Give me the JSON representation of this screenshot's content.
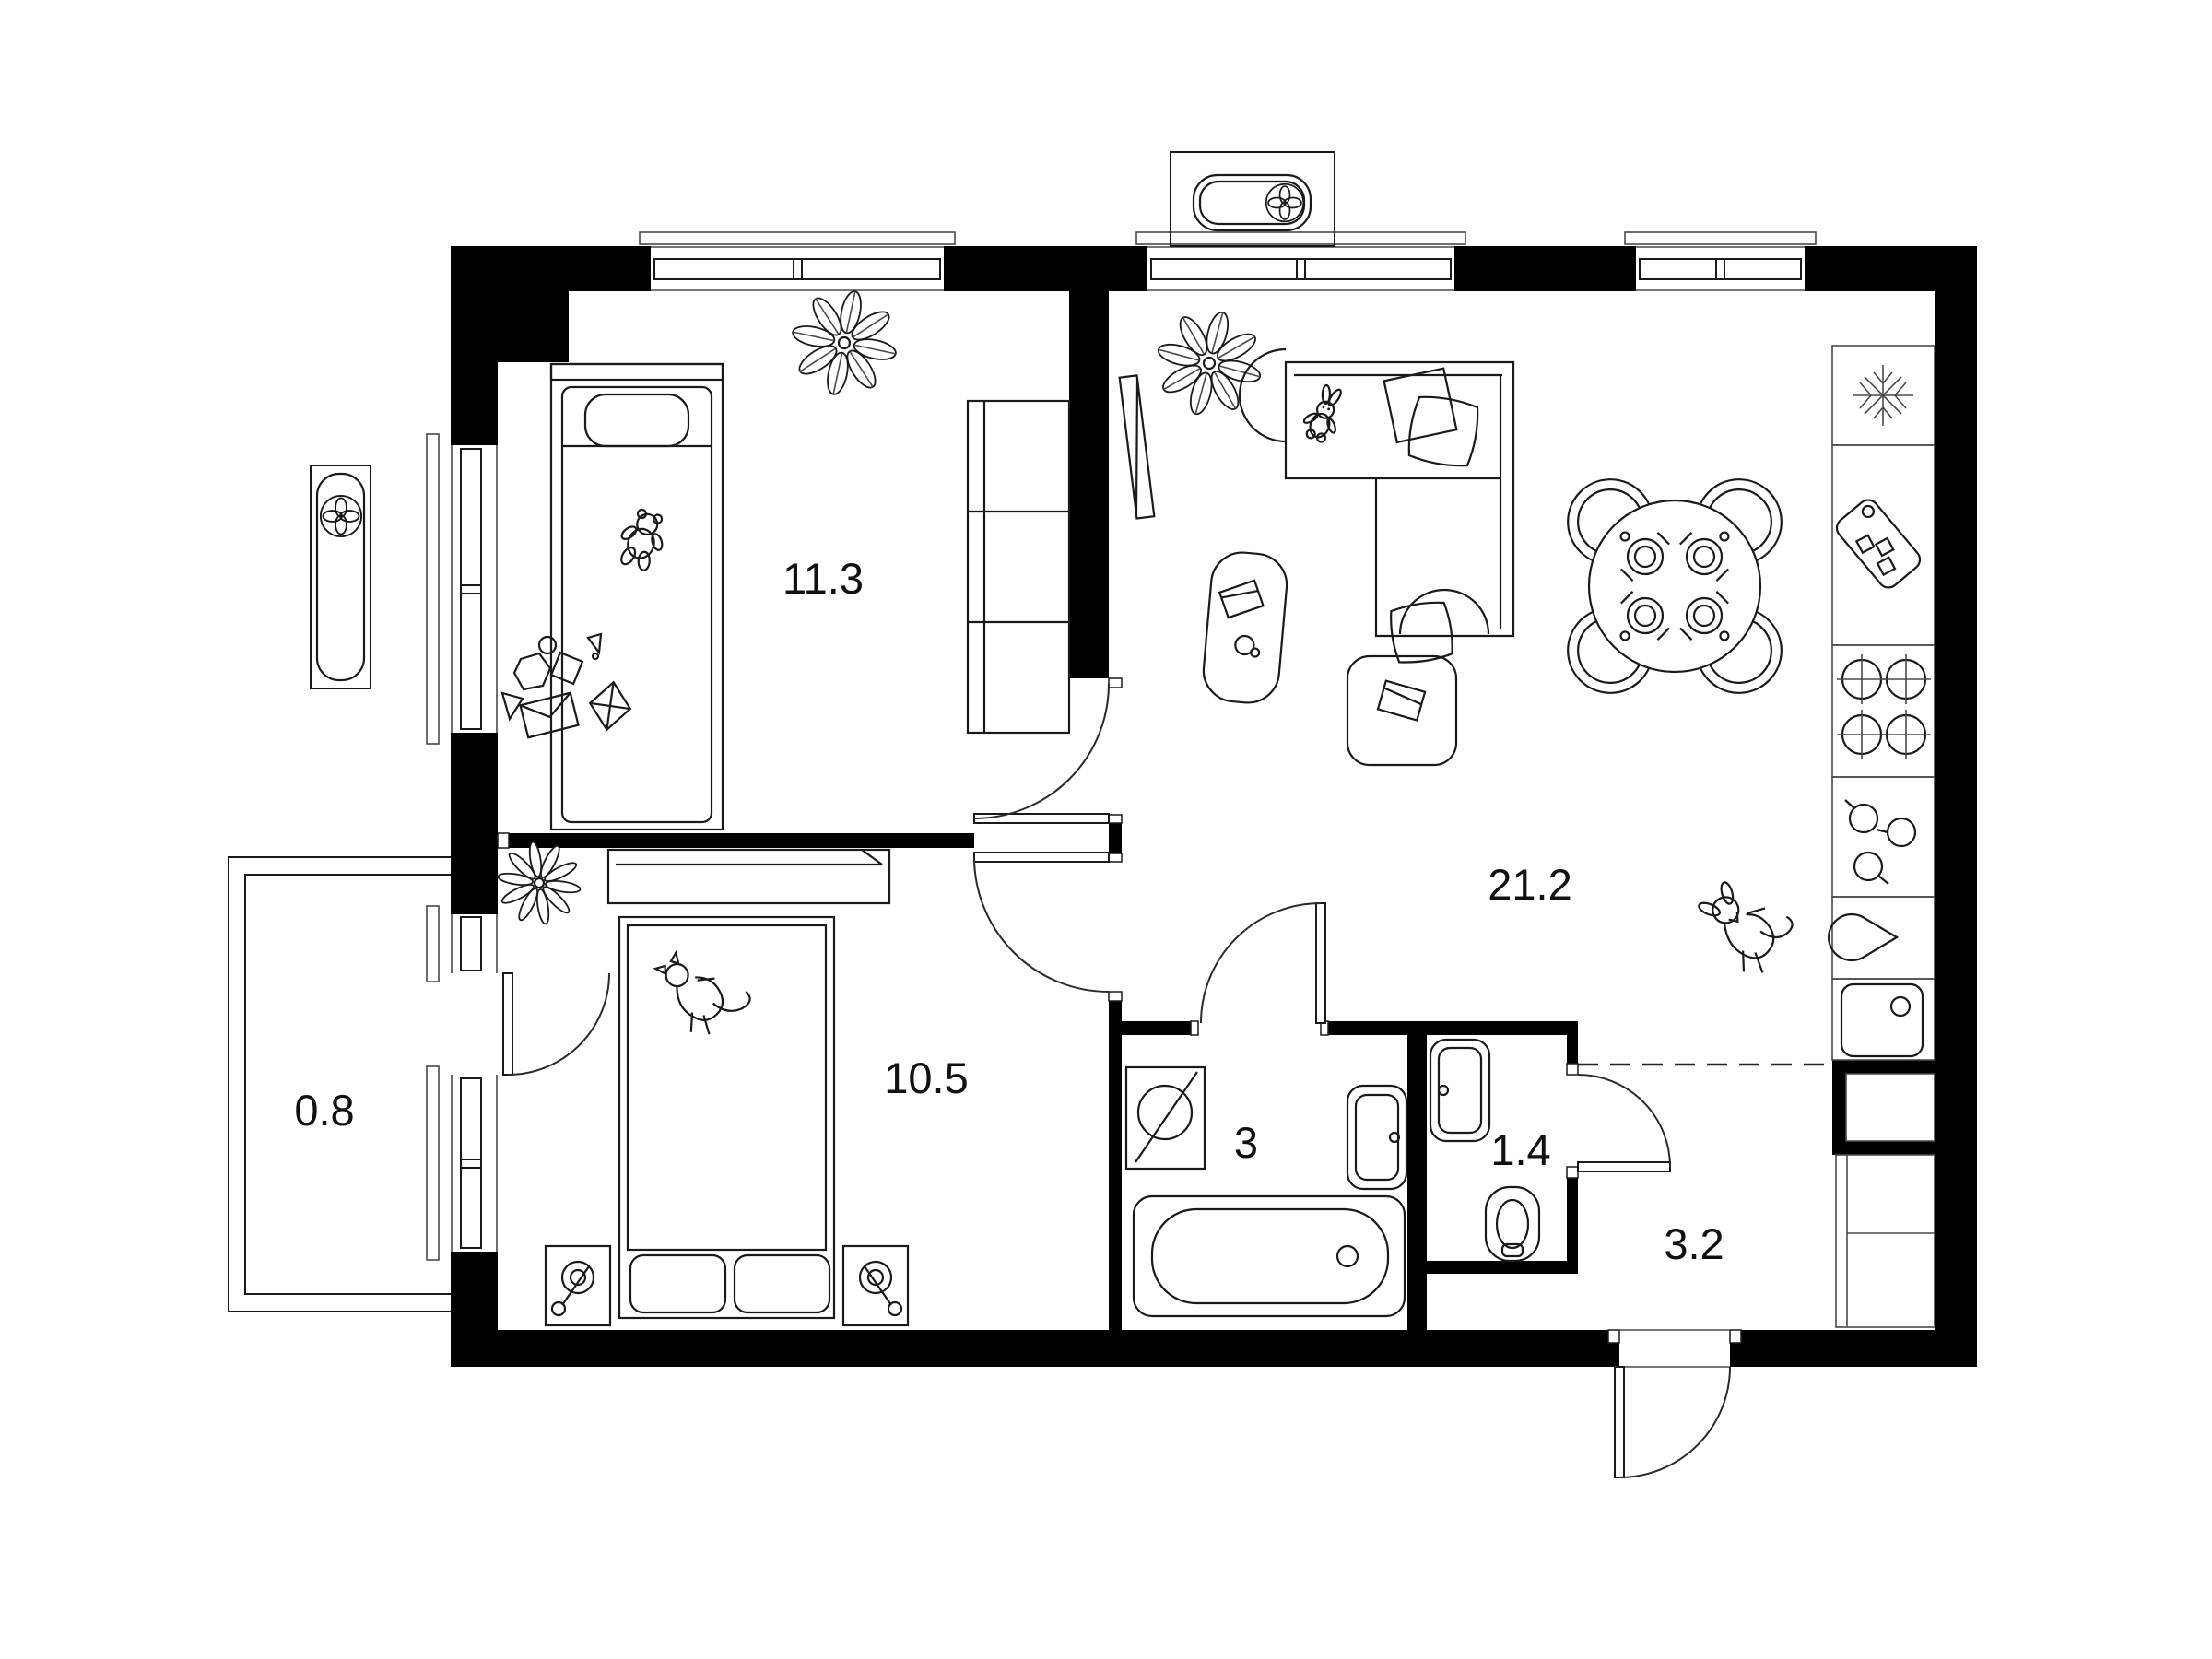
{
  "floorplan": {
    "type": "apartment-floor-plan-2-rooms",
    "rooms": [
      {
        "name": "bedroom-1",
        "area_label": "11.3"
      },
      {
        "name": "living-room-kitchen",
        "area_label": "21.2"
      },
      {
        "name": "bedroom-2",
        "area_label": "10.5"
      },
      {
        "name": "bathroom",
        "area_label": "3"
      },
      {
        "name": "toilet",
        "area_label": "1.4"
      },
      {
        "name": "hallway",
        "area_label": "3.2"
      },
      {
        "name": "balcony",
        "area_label": "0.8"
      }
    ],
    "icons": [
      "single-bed-icon",
      "teddy-bear-icon",
      "plant-icon",
      "wardrobe-icon",
      "toy-blocks-icon",
      "double-bed-icon",
      "cat-icon",
      "nightstand-lamp-icon",
      "desk-icon",
      "flower-icon",
      "corner-sofa-icon",
      "pillow-icon",
      "bunny-icon",
      "tv-icon",
      "coffee-table-icon",
      "armchair-icon",
      "dining-table-icon",
      "chair-icon",
      "plate-cutlery-icon",
      "dog-icon",
      "fridge-snowflake-icon",
      "cutting-board-icon",
      "stove-burners-icon",
      "cookware-icon",
      "faucet-drop-icon",
      "kitchen-sink-icon",
      "washing-machine-icon",
      "bathtub-icon",
      "washbasin-icon",
      "toilet-icon",
      "ac-fan-unit-icon",
      "closet-icon",
      "door-swing-arc",
      "window-glyph"
    ],
    "colors": {
      "walls": "#000000",
      "lines": "#1a1a1a",
      "background": "#ffffff"
    }
  }
}
